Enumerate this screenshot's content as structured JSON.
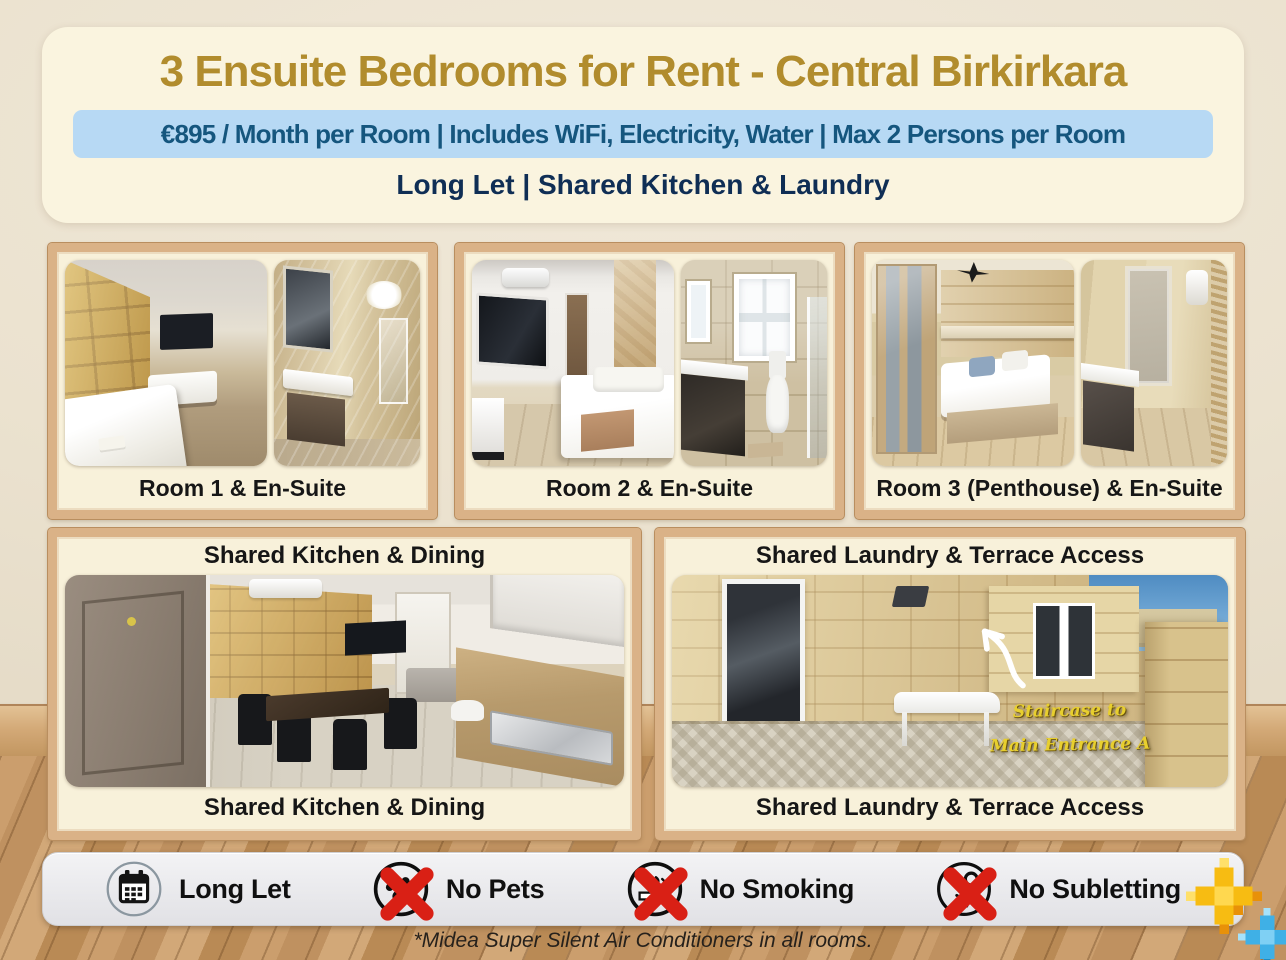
{
  "header": {
    "title": "3 Ensuite Bedrooms for Rent - Central Birkirkara",
    "price_line": "€895 / Month per Room | Includes WiFi, Electricity, Water | Max 2 Persons per Room",
    "terms_line": "Long Let | Shared Kitchen & Laundry"
  },
  "panels": {
    "room1": {
      "caption": "Room 1 & En-Suite"
    },
    "room2": {
      "caption": "Room 2 & En-Suite"
    },
    "room3": {
      "caption": "Room 3 (Penthouse) & En-Suite"
    },
    "kitchen": {
      "caption": "Shared Kitchen & Dining"
    },
    "laundry": {
      "caption": "Shared Laundry & Terrace Access",
      "overlay_line1": "Staircase to",
      "overlay_line2": "Main Entrance A"
    }
  },
  "amenities": {
    "items": [
      {
        "label": "Long Let",
        "icon": "calendar-icon"
      },
      {
        "label": "No Pets",
        "icon": "no-pets-icon"
      },
      {
        "label": "No Smoking",
        "icon": "no-smoking-icon"
      },
      {
        "label": "No Subletting",
        "icon": "no-subletting-icon"
      }
    ]
  },
  "footer": {
    "note": "*Midea Super Silent Air Conditioners in all rooms."
  },
  "colors": {
    "title_gold": "#b18c2d",
    "price_bg": "#b7d9f4",
    "price_text": "#15567e",
    "terms_text": "#0f2e55",
    "frame_wood": "#dab287",
    "panel_bg": "#f8f1da",
    "bar_bg": "#e9e9ec",
    "prohibit_red": "#d92015",
    "overlay_yellow": "#e8cf2e"
  }
}
